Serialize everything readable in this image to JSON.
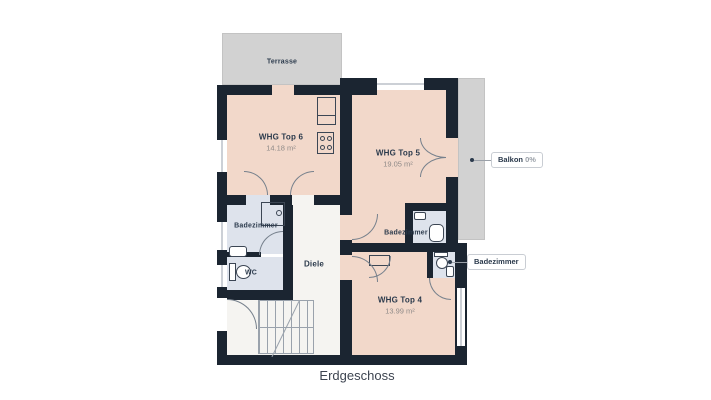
{
  "floor_label": "Erdgeschoss",
  "outdoor": {
    "terrasse_label": "Terrasse",
    "balkon_chip": {
      "label": "Balkon",
      "value": "0%"
    },
    "badezimmer_chip": {
      "label": "Badezimmer"
    }
  },
  "apartments": [
    {
      "name": "WHG Top 6",
      "area": "14.18 m²"
    },
    {
      "name": "WHG Top 5",
      "area": "19.05 m²"
    },
    {
      "name": "WHG Top 4",
      "area": "13.99 m²"
    }
  ],
  "rooms": {
    "badezimmer_left": "Badezimmer",
    "wc": "WC",
    "diele": "Diele",
    "badezimmer_mid": "Badezimmer"
  },
  "colors": {
    "wall": "#1b2531",
    "apartment": "#f2d8ca",
    "bathroom": "#dee3ec",
    "hall": "#f5f4f1",
    "outdoor": "#d2d2d2",
    "label": "#2b3a4c",
    "muted": "#8f8a88",
    "chip_border": "#c9cdd3"
  }
}
